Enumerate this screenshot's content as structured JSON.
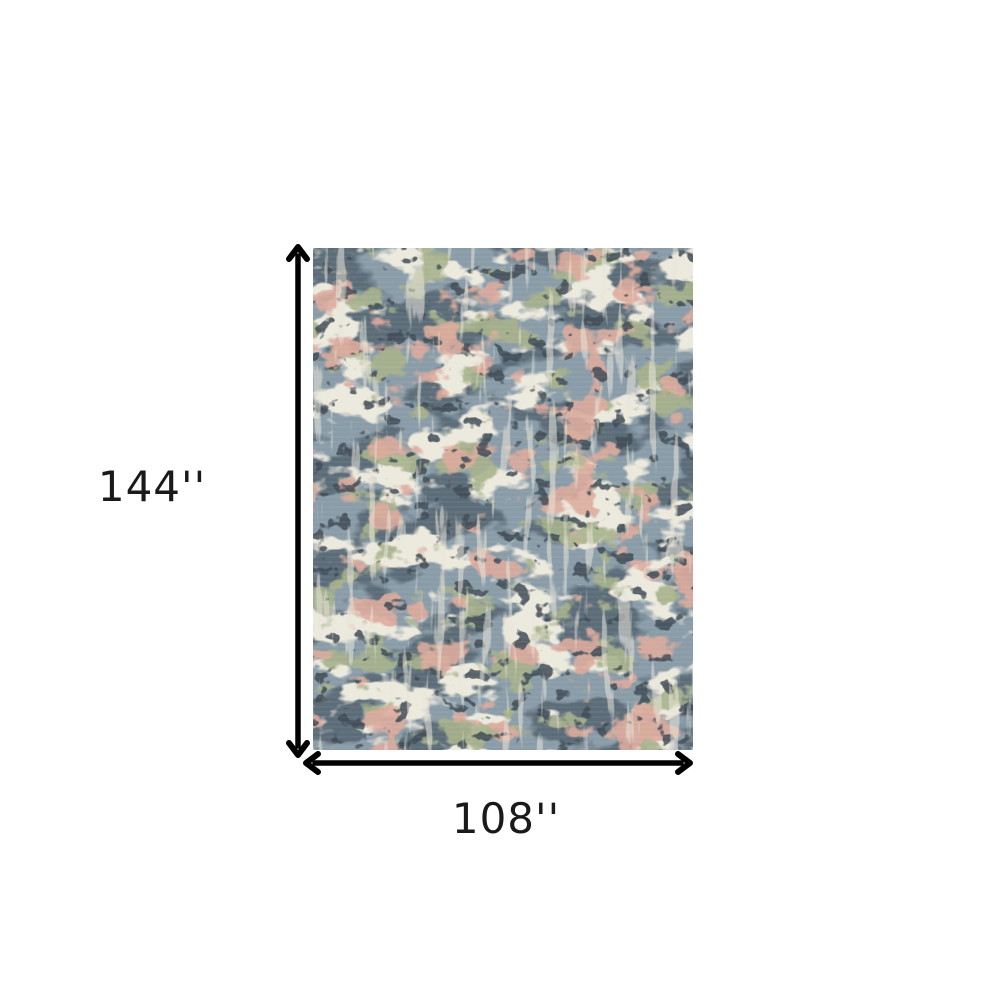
{
  "page": {
    "background": "#ffffff"
  },
  "diagram": {
    "type": "product-dimension-diagram",
    "height_label": "144''",
    "width_label": "108''",
    "arrow_color": "#000000",
    "label_color": "#1a1a1a",
    "rug": {
      "style": "abstract distressed area rug",
      "colors": {
        "base": "#8a9ca8",
        "dark_slate": "#5c6d79",
        "cream": "#ece9dd",
        "sage_green": "#a7b28c",
        "blush_pink": "#dcab9d",
        "charcoal": "#3f4c55",
        "streak_light": "#e9e6da"
      }
    }
  }
}
